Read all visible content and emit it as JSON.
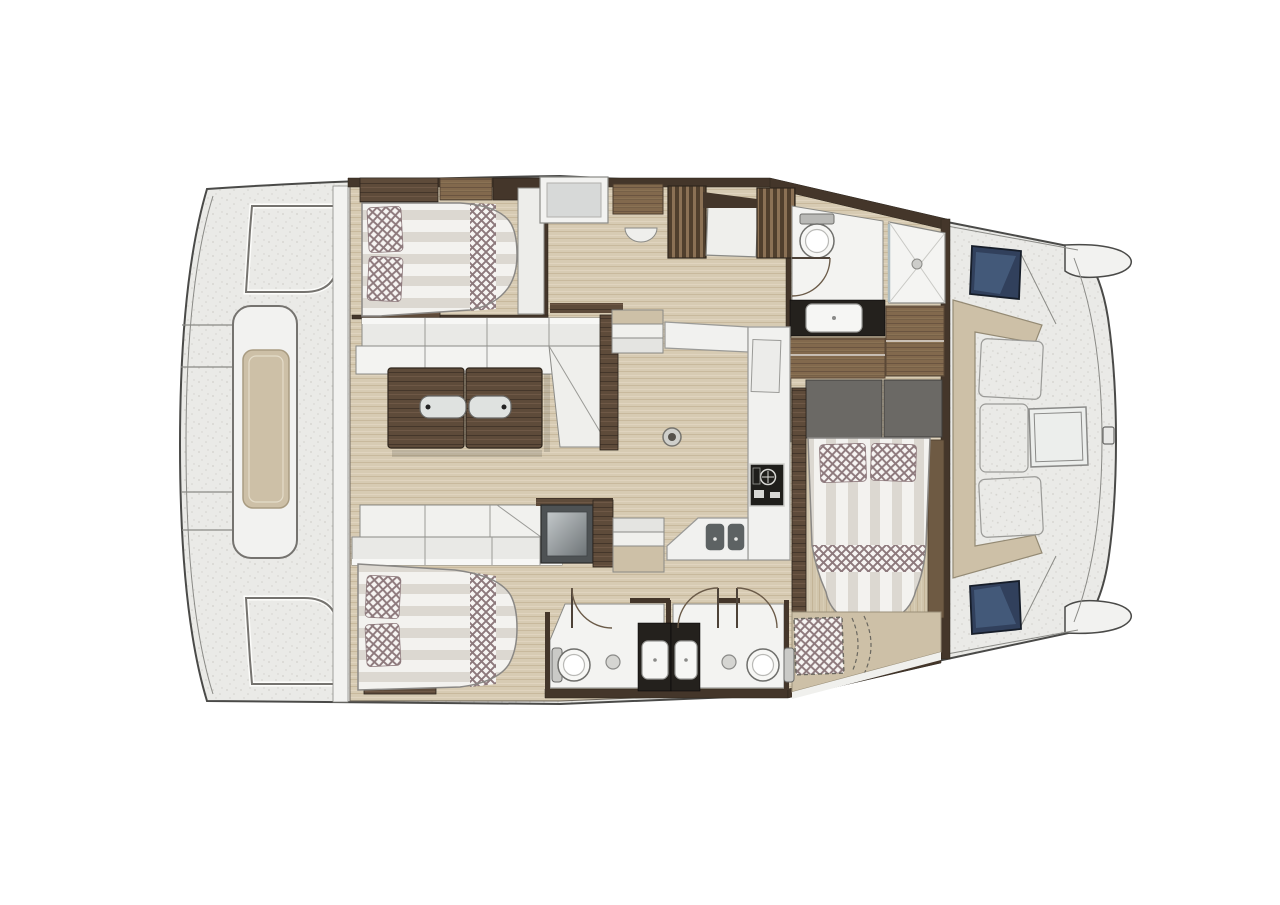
{
  "meta": {
    "description": "Overhead interior layout plan of a cruising catamaran: aft platform with bench, saloon with L-shaped sofa and wood table, U-shaped galley with cooktop and double sink, three double-berth cabins, three bathrooms (one with separate shower), forward cockpit with C-shaped lounge and table, twin bows with deck hatches"
  },
  "palette": {
    "background": "#ffffff",
    "hull_line": "#4a4a48",
    "deck": "#eaeae7",
    "deck_dot": "#d2d1cc",
    "white_panel": "#f2f2f0",
    "panel_shade": "#d9d8d4",
    "outline": "#8a8a86",
    "floor": "#d7cbb3",
    "floor_line": "#c8b99d",
    "floor_hi": "#e2d7c2",
    "walnut": "#5e4b3a",
    "walnut_dark": "#44362a",
    "walnut_hi": "#715c48",
    "wood_dark": "#503f2d",
    "wood_light": "#8b7155",
    "wood_mid": "#82694d",
    "wood_mid_dark": "#6a5440",
    "beige": "#cdc0a7",
    "duvet_light": "#f3f2ef",
    "duvet_shade": "#dcd8d1",
    "check_bg": "#f7f5f3",
    "check_fg": "#8d797c",
    "headboard": "#6b6965",
    "appliance": "#4e5254",
    "appliance_face": "#a7acae",
    "counter_black": "#24211d",
    "fixture_white": "#f7f7f5",
    "hatch_blue": "#31405c",
    "hatch_blue_hi": "#4a6183",
    "glass": "#dfe2e0"
  },
  "rooms": [
    {
      "id": "aft-platform",
      "label": "aft platform and cockpit bench"
    },
    {
      "id": "saloon",
      "label": "saloon with L-sofa and folding wood table"
    },
    {
      "id": "galley",
      "label": "U-shaped galley with cooktop and double sink"
    },
    {
      "id": "port-cabin",
      "label": "port hull double-berth cabin with wardrobes"
    },
    {
      "id": "port-bathroom",
      "label": "port bathroom with toilet, vanity and separate shower"
    },
    {
      "id": "owner-cabin",
      "label": "forward owner cabin with double berth"
    },
    {
      "id": "starboard-cabin",
      "label": "starboard hull double-berth cabin"
    },
    {
      "id": "starboard-bathroom-aft",
      "label": "starboard aft bathroom with toilet and vanity"
    },
    {
      "id": "starboard-bathroom-fwd",
      "label": "starboard forward bathroom with toilet and vanity"
    },
    {
      "id": "bow-cockpit",
      "label": "forward cockpit with C-shaped lounge and table"
    },
    {
      "id": "foredeck",
      "label": "foredeck with twin bows and deck hatches"
    }
  ],
  "fixtures": {
    "double_berths": 3,
    "toilets": 3,
    "showers": 1,
    "vanity_sinks": 3,
    "galley_sink_basins": 2,
    "cooktops": 1,
    "saloon_tables": 1,
    "cockpit_tables": 1,
    "stairways": 2,
    "door_swings": 4,
    "deck_hatches": 2,
    "floor_hatches": 1,
    "sunpads": 1
  }
}
